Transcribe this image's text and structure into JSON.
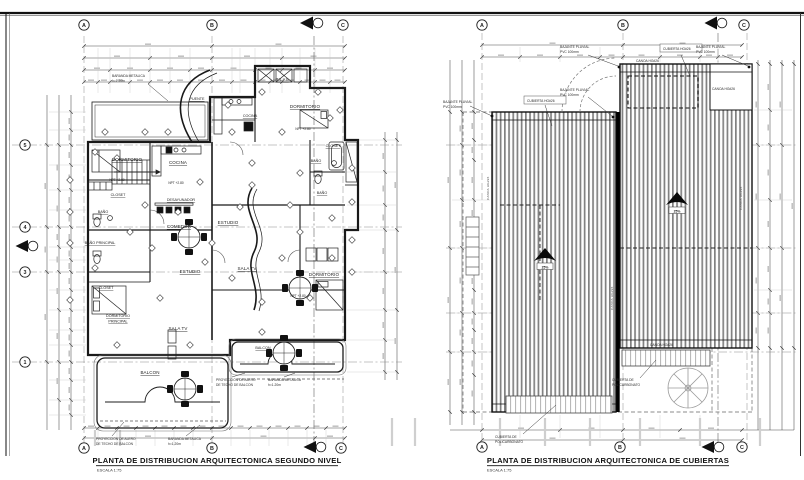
{
  "sheet": {
    "bg": "#ffffff",
    "ink": "#1c1c1c",
    "hatch": "#818181"
  },
  "left_plan": {
    "title": "PLANTA DE DISTRIBUCION ARQUITECTONICA SEGUNDO NIVEL",
    "scale": "ESCALA 1:75",
    "grid": {
      "col_a": "A",
      "col_b": "B",
      "col_c": "C",
      "row_5": "5",
      "row_4": "4",
      "row_3": "3",
      "row_1": "1"
    },
    "rooms": {
      "pilas": "PILAS",
      "puente": "PUENTE",
      "cocina_a": "COCINA",
      "cocina_b": "COCINA",
      "dormitorio_a": "DORMITORIO",
      "dormitorio_b": "DORMITORIO",
      "dormitorio_c": "DORMITORIO",
      "dormitorio_ppal_l1": "DORMITORIO",
      "dormitorio_ppal_l2": "PRINCIPAL",
      "bano_a": "BAÑO",
      "bano_b": "BAÑO",
      "bano_c": "BAÑO",
      "bano_ppal": "BAÑO PRINCIPAL",
      "closet_a": "CLOSET",
      "closet_b": "CLOSET",
      "closet_c": "CLOSET",
      "estudio_a": "ESTUDIO",
      "estudio_b": "ESTUDIO",
      "comedor": "COMEDOR",
      "desayunador": "DESAYUNADOR",
      "sala_tv_a": "SALA TV",
      "sala_tv_b": "SALA TV",
      "balcon_a": "BALCON",
      "balcon_b": "BALCON"
    },
    "annotations": {
      "baranda_l1": "BARANDA METALICA",
      "baranda_l2": "h=1.20m",
      "alero_l1": "PROYECCION DE ALERO",
      "alero_l2": "DE TECHO DE BALCON",
      "npt": "NPT +2.80"
    }
  },
  "right_plan": {
    "title": "PLANTA DE DISTRIBUCION ARQUITECTONICA DE CUBIERTAS",
    "scale": "ESCALA 1:75",
    "grid": {
      "col_a": "A",
      "col_b": "B",
      "col_c": "C"
    },
    "labels": {
      "bajante_l1": "BAJANTE PLUVIAL",
      "bajante_l2": "PVC 100mm",
      "cubierta": "CUBIERTA HG#26",
      "canoa": "CANOA HG#26",
      "poli_l1": "CUBIERTA DE",
      "poli_l2": "POLICARBONATO",
      "slope": "25%"
    }
  }
}
